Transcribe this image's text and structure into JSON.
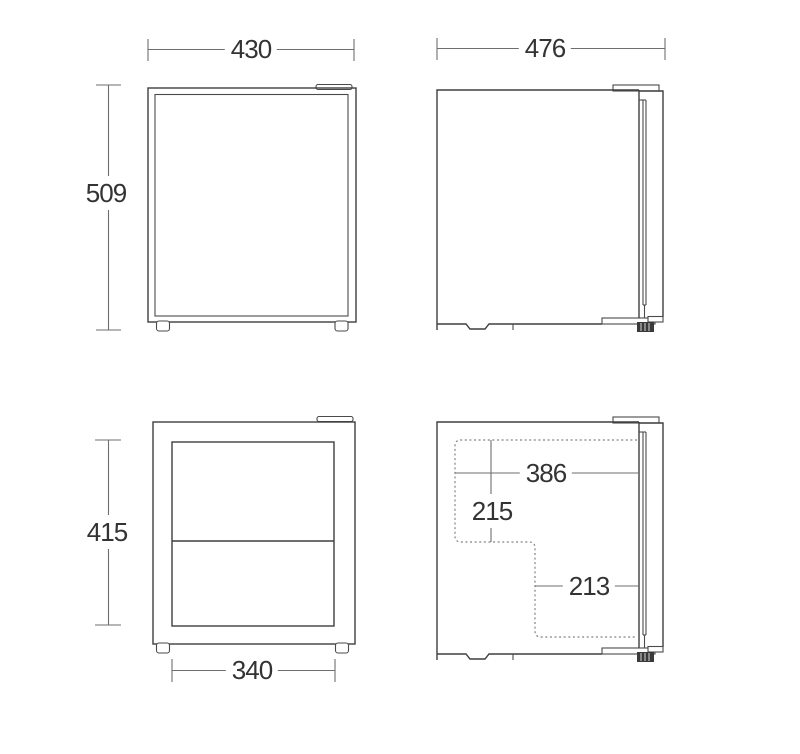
{
  "diagram": {
    "type": "technical-dimension-drawing",
    "subject": "compact refrigerator shown in four orthographic views",
    "colors": {
      "background": "#ffffff",
      "object_line": "#3f3f3f",
      "dimension_line": "#6e6e6e",
      "dotted_line": "#828282",
      "text": "#333333"
    },
    "views": [
      {
        "id": "front-exterior",
        "position": "top-left",
        "dimensions": [
          {
            "name": "overall-width",
            "label": "430",
            "orientation": "horizontal",
            "placement": "above"
          },
          {
            "name": "overall-height",
            "label": "509",
            "orientation": "vertical",
            "placement": "left"
          }
        ]
      },
      {
        "id": "side-exterior",
        "position": "top-right",
        "dimensions": [
          {
            "name": "overall-depth",
            "label": "476",
            "orientation": "horizontal",
            "placement": "above"
          }
        ]
      },
      {
        "id": "front-interior",
        "position": "bottom-left",
        "dimensions": [
          {
            "name": "interior-height",
            "label": "415",
            "orientation": "vertical",
            "placement": "left"
          },
          {
            "name": "interior-width",
            "label": "340",
            "orientation": "horizontal",
            "placement": "below"
          }
        ]
      },
      {
        "id": "side-interior",
        "position": "bottom-right",
        "dimensions": [
          {
            "name": "interior-depth-upper",
            "label": "386",
            "orientation": "horizontal",
            "placement": "inside"
          },
          {
            "name": "interior-height-upper",
            "label": "215",
            "orientation": "vertical",
            "placement": "inside"
          },
          {
            "name": "interior-depth-lower",
            "label": "213",
            "orientation": "horizontal",
            "placement": "inside"
          }
        ]
      }
    ]
  }
}
